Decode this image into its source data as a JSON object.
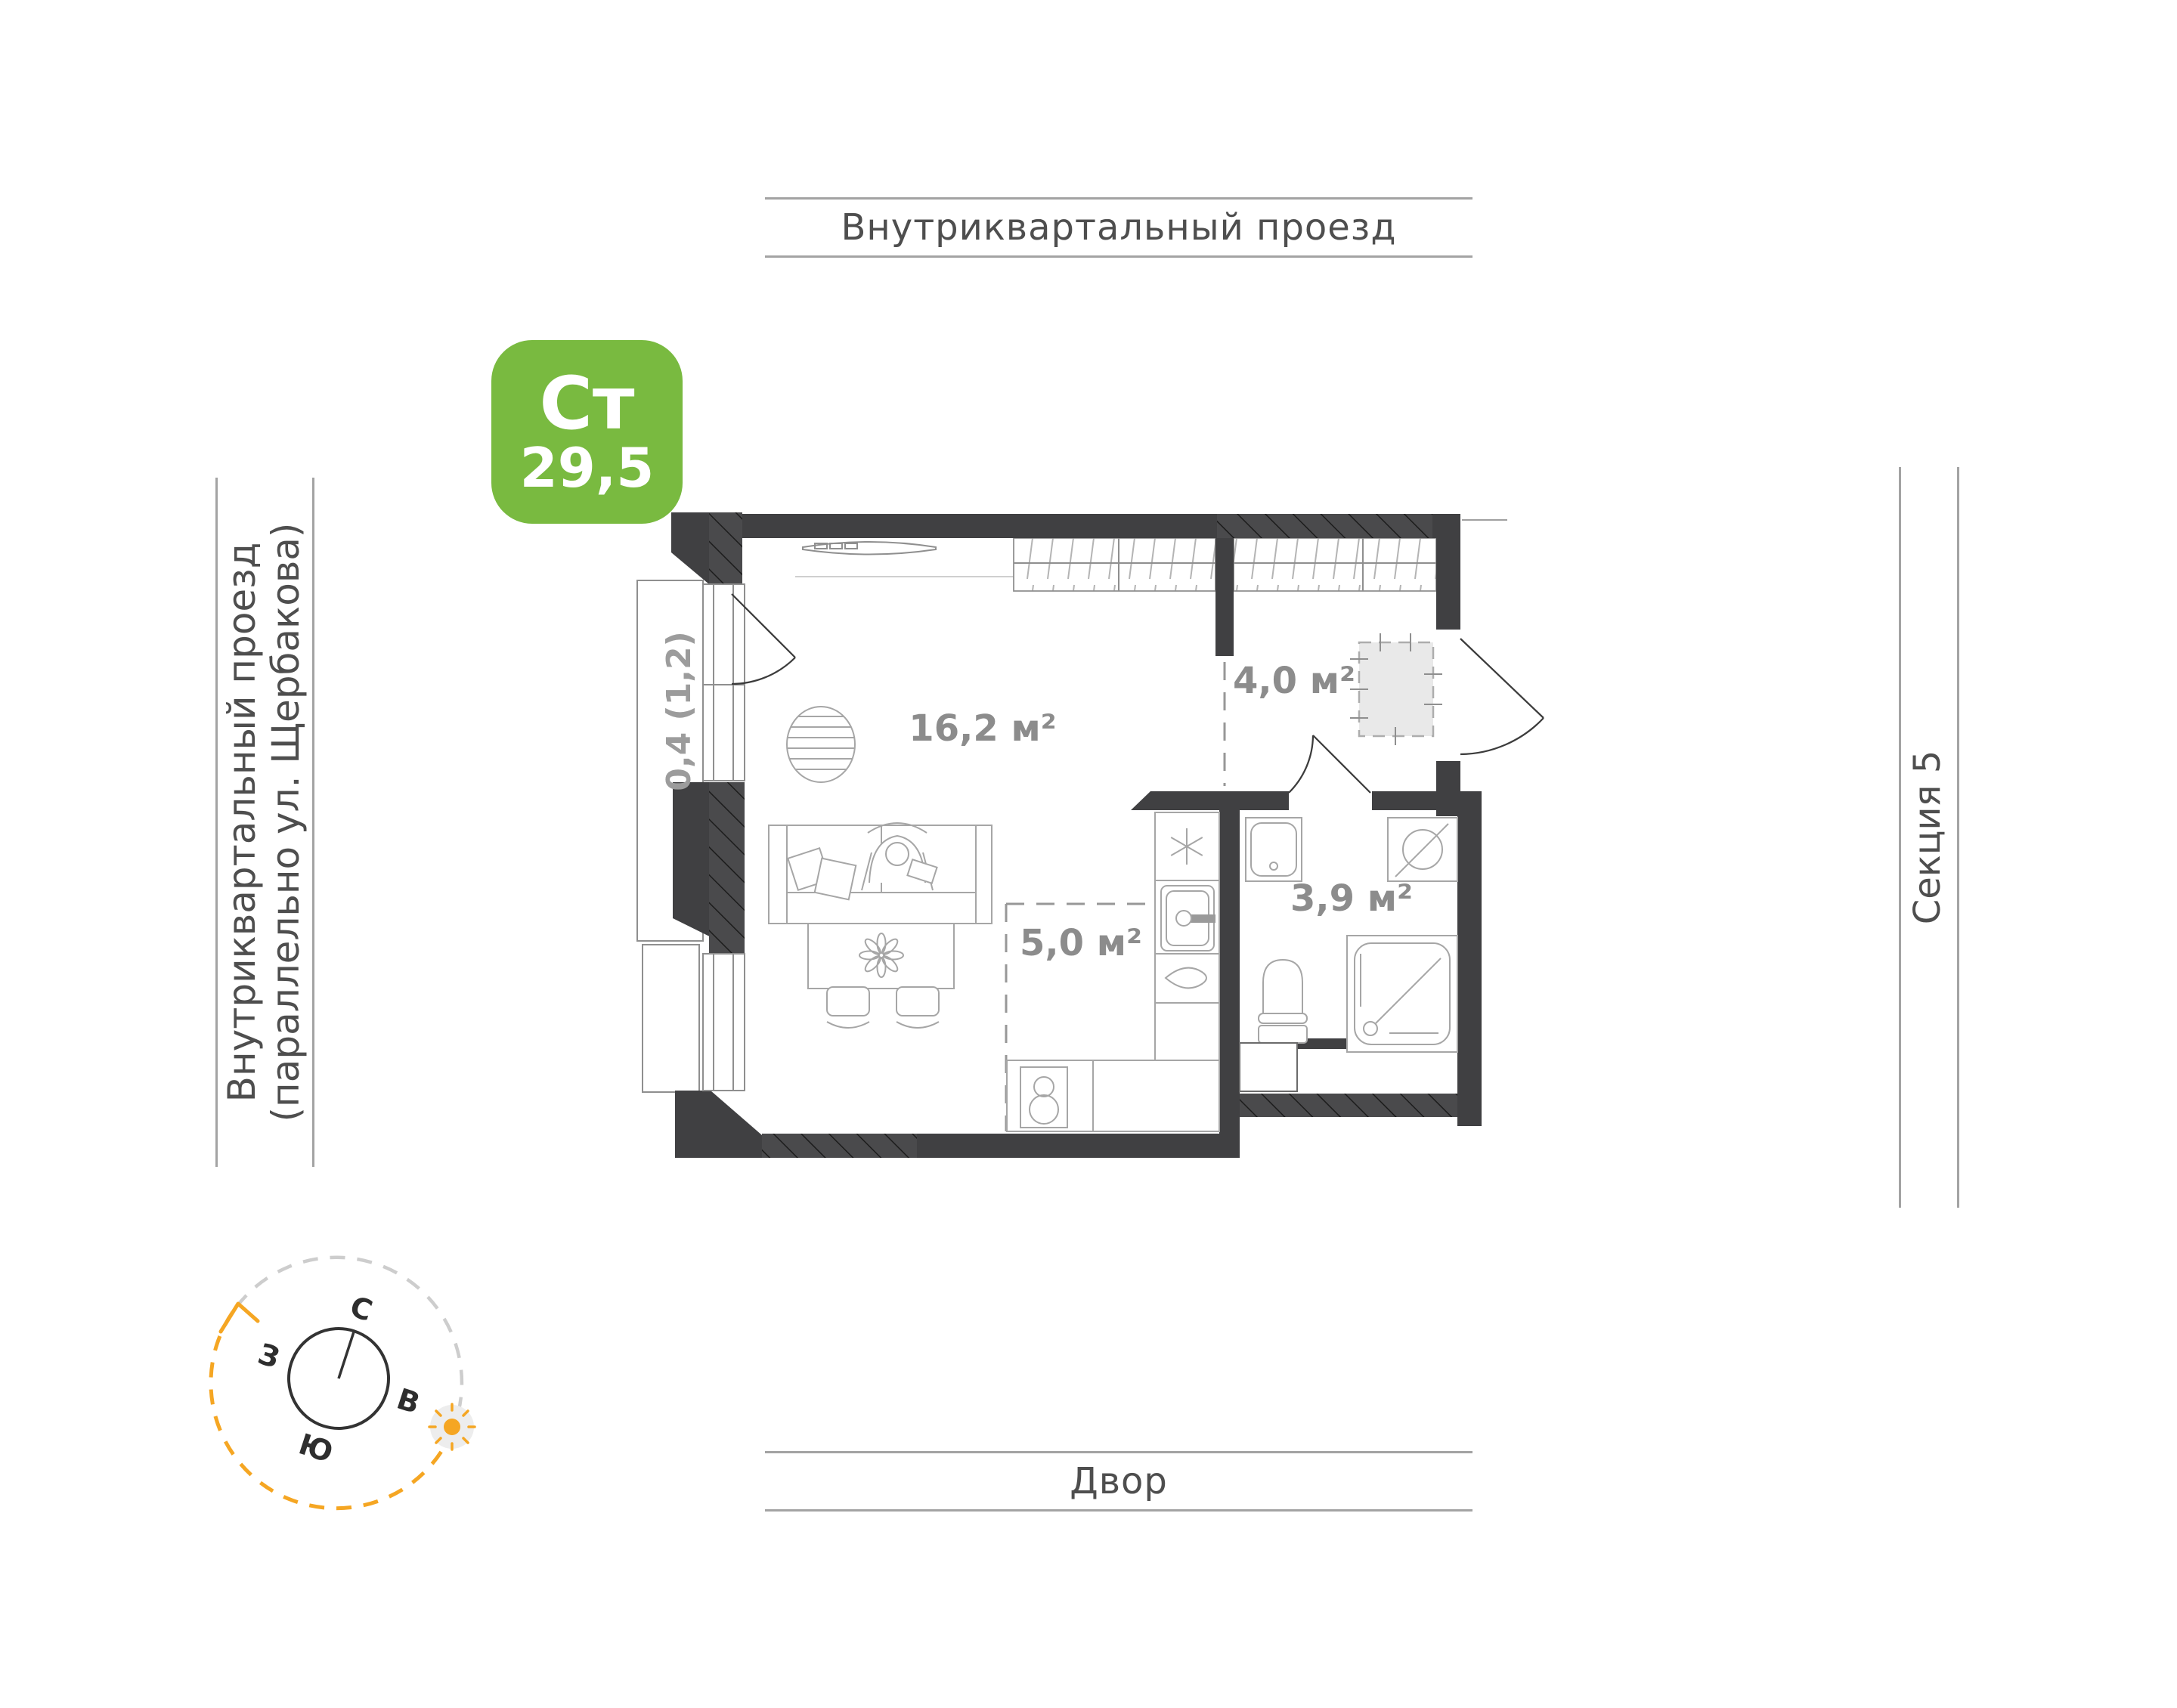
{
  "context": {
    "street_top": "Внутриквартальный проезд",
    "street_left_line1": "Внутриквартальный проезд",
    "street_left_line2": "(параллельно ул. Щербакова)",
    "section_right": "Секция 5",
    "yard_bottom": "Двор"
  },
  "badge": {
    "type_label": "Ст",
    "total_area": "29,5"
  },
  "plan": {
    "living_area": "16,2 м²",
    "hall_area": "4,0 м²",
    "kitchen_area": "5,0 м²",
    "bathroom_area": "3,9 м²",
    "balcony_area": "0,4 (1,2)"
  },
  "compass": {
    "north": "С",
    "east": "В",
    "south": "Ю",
    "west": "З"
  },
  "colors": {
    "badge_green": "#79ba40",
    "accent_orange": "#f5a623",
    "wall_dark": "#404042",
    "label_gray": "#8c8c8c",
    "line_gray": "#a3a3a3"
  }
}
